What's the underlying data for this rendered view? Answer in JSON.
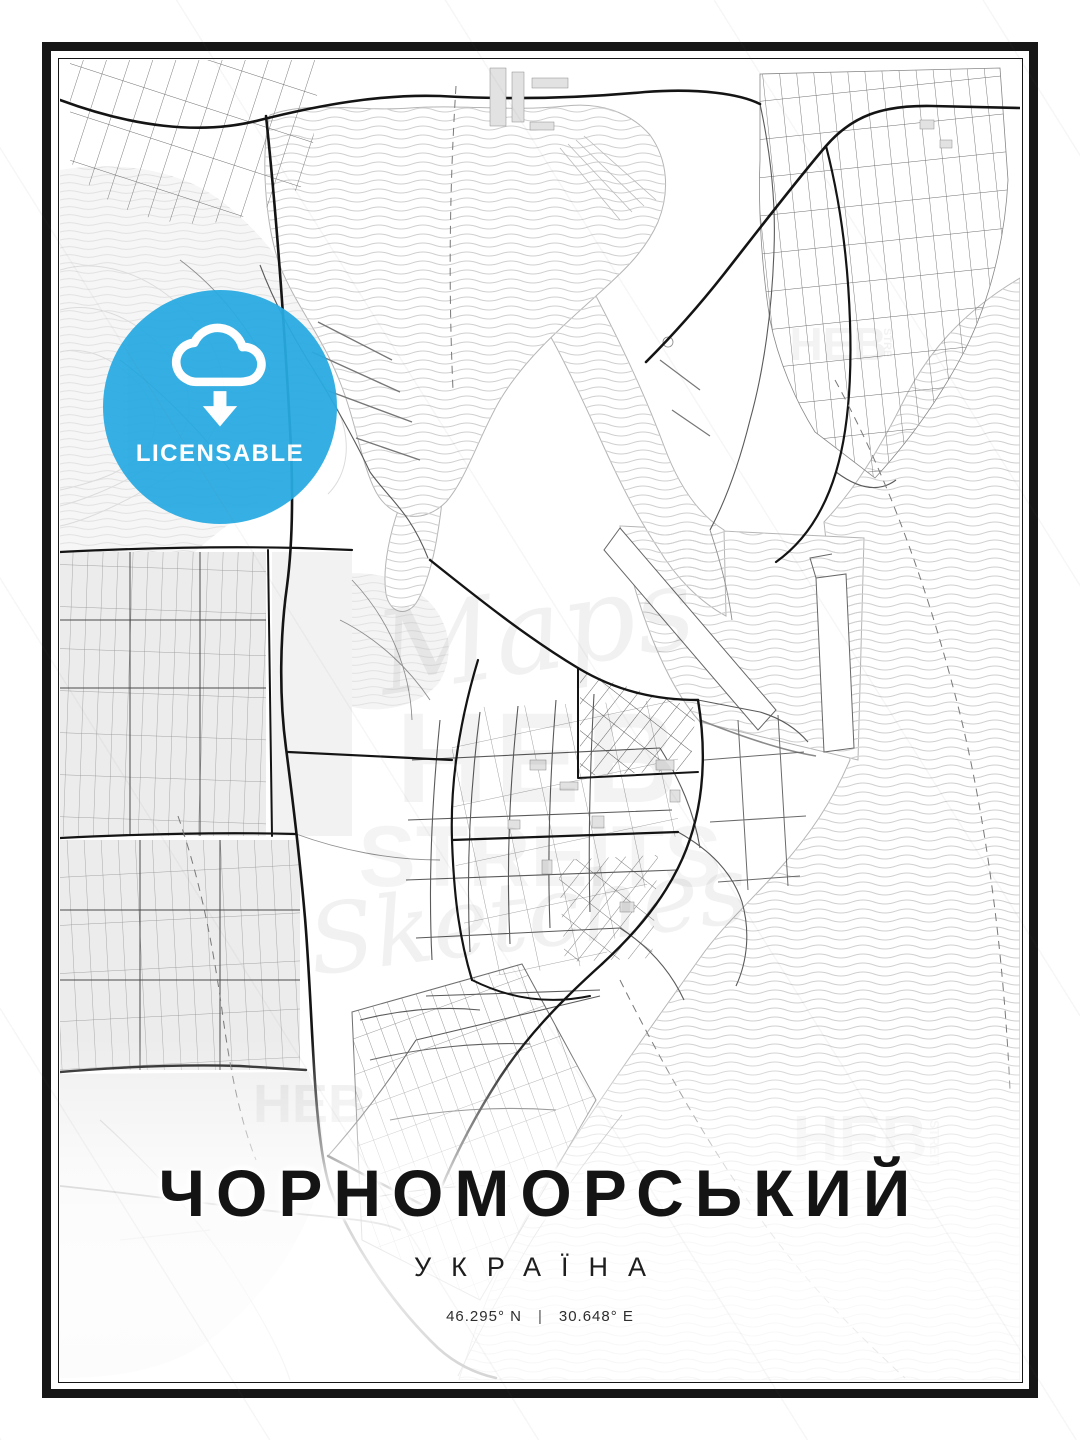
{
  "poster": {
    "title": "ЧОРНОМОРСЬКИЙ",
    "subtitle": "УКРАЇНА",
    "coordinates": {
      "lat": "46.295° N",
      "separator": "|",
      "lon": "30.648° E"
    }
  },
  "badge": {
    "label": "LICENSABLE",
    "color": "#29abe2",
    "icon": "cloud-download-icon"
  },
  "watermarks": {
    "center_script_top": "Maps",
    "center_heb": "HEB",
    "center_streits": "STREITS",
    "center_script_bottom": "Sketches",
    "bottom_left_heb": "HEB",
    "bottom_right_heb": "HEB",
    "bottom_right_streit": "STREIT",
    "top_right_heb": "HEB",
    "top_right_stre": "STRE"
  },
  "map": {
    "style": {
      "frame": "#161616",
      "major_road": "#141414",
      "minor_road": "#8f8f8f",
      "water_wave": "#cfcfcf",
      "land_fill": "#ededed"
    }
  }
}
